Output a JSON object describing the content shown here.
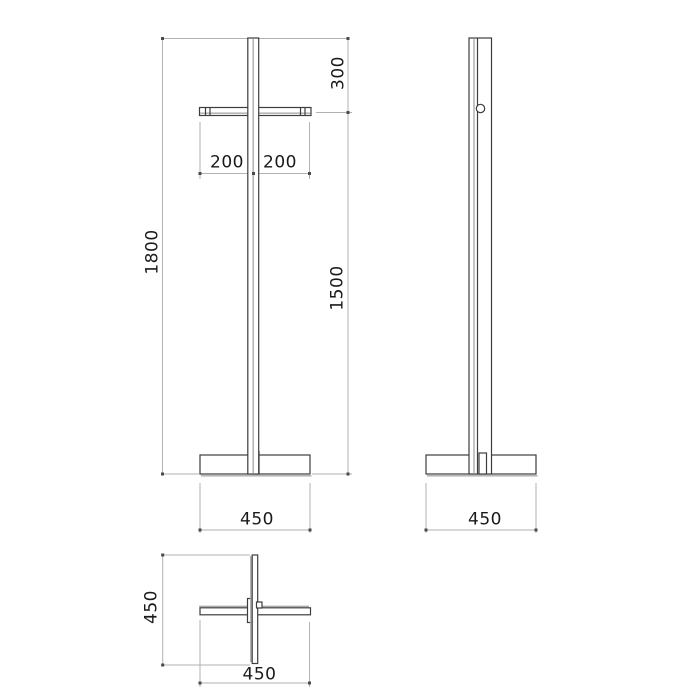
{
  "drawing_type": "technical-dimension-drawing",
  "views": {
    "front": "front-view",
    "side": "side-view",
    "plan": "plan-view"
  },
  "labels": {
    "overall_height": "1800",
    "top_to_crossbar": "300",
    "crossbar_to_base": "1500",
    "crossbar_left_half": "200",
    "crossbar_right_half": "200",
    "front_base_width": "450",
    "side_base_width": "450",
    "plan_depth": "450",
    "plan_width": "450"
  },
  "colors": {
    "object_line": "#3d3d3d",
    "dimension_line": "#b2b2b2",
    "accent_line": "#ababab",
    "tick": "#4a4a4a",
    "text": "#1a1a1a",
    "background": "#ffffff"
  }
}
